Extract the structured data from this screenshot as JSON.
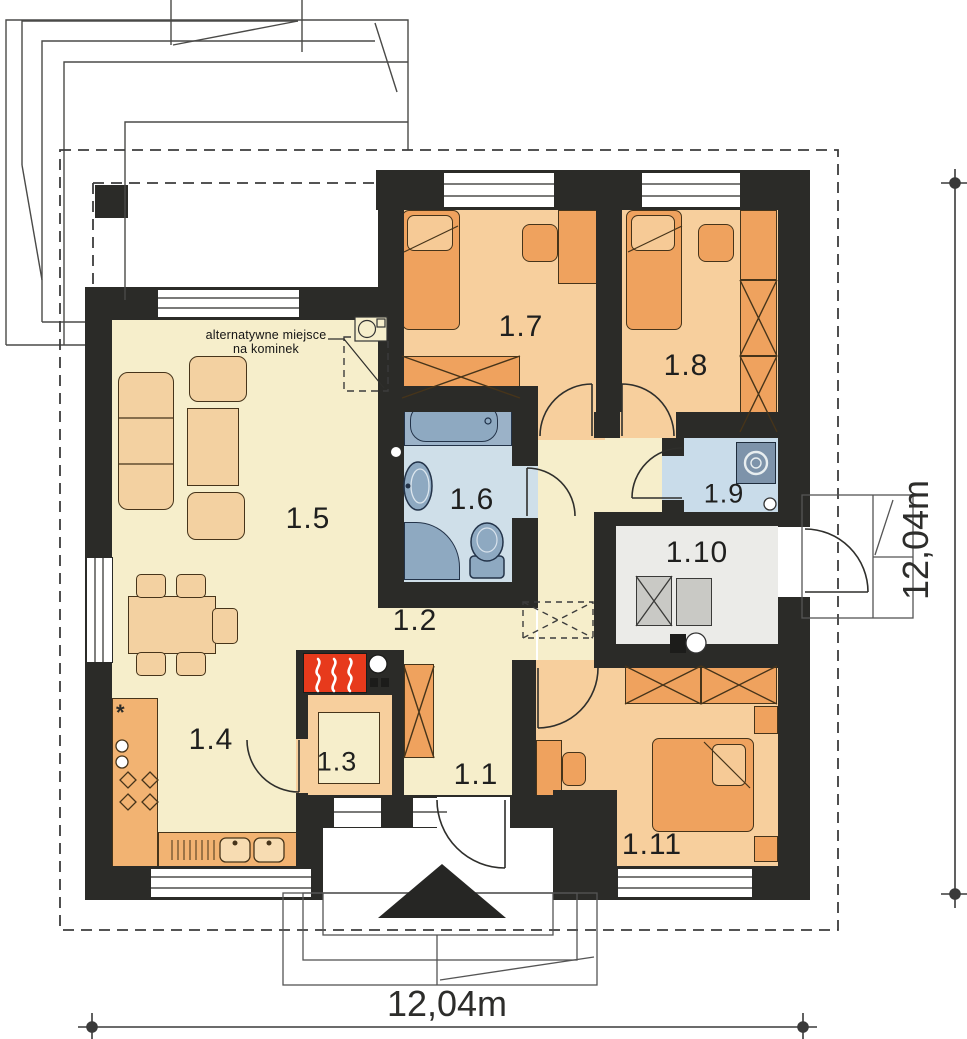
{
  "plan": {
    "rooms": [
      {
        "label": "1.1"
      },
      {
        "label": "1.2"
      },
      {
        "label": "1.3"
      },
      {
        "label": "1.4"
      },
      {
        "label": "1.5"
      },
      {
        "label": "1.6"
      },
      {
        "label": "1.7"
      },
      {
        "label": "1.8"
      },
      {
        "label": "1.9"
      },
      {
        "label": "1.10"
      },
      {
        "label": "1.11"
      }
    ],
    "annotation": {
      "line1": "alternatywne miejsce",
      "line2": "na kominek"
    },
    "dimensions": {
      "bottom": "12,04m",
      "right": "12,04m"
    },
    "symbols": {
      "fridge": "*"
    },
    "colors": {
      "wall": "#2b2b28",
      "floor_cream": "#f6eecb",
      "floor_orange": "#f7cf9d",
      "furniture_orange": "#efa25e",
      "furniture_light": "#f3d1a1",
      "bath_floor": "#cfdfe9",
      "fixture_blue": "#8ea9c1",
      "utility_floor": "#c9dcea",
      "boiler_floor": "#ebebe8",
      "appliance_gray": "#c9c9c5",
      "fireplace_red": "#e73a1c"
    }
  }
}
